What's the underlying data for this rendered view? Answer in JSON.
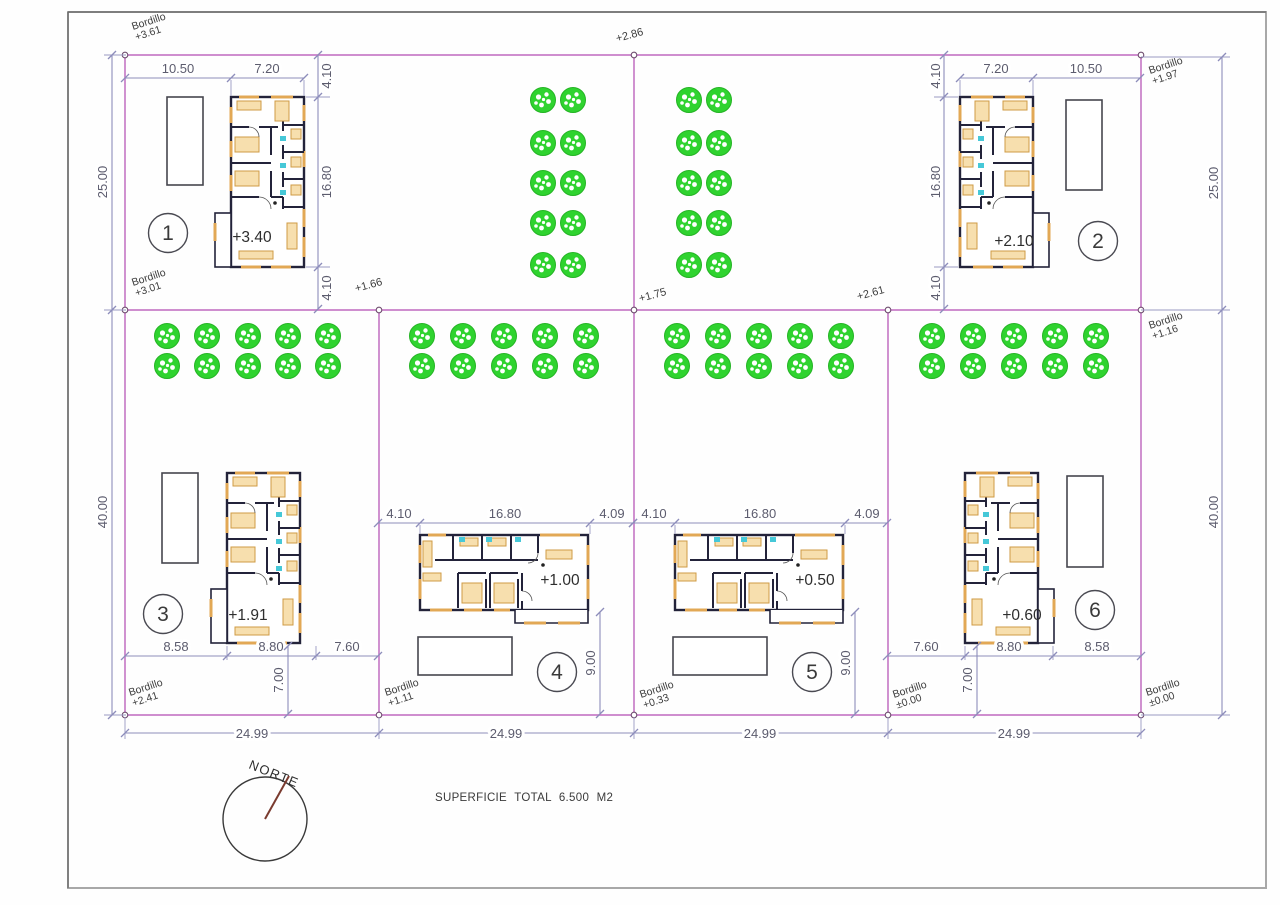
{
  "drawing": {
    "superficie": "SUPERFICIE TOTAL 6.500 M2",
    "north": "NORTE"
  },
  "site": {
    "left_dim_top": "25.00",
    "left_dim_bottom": "40.00",
    "right_dim_top": "25.00",
    "right_dim_bottom": "40.00",
    "bottom_dims": [
      "24.99",
      "24.99",
      "24.99",
      "24.99"
    ],
    "spot": {
      "top": "+2.86",
      "mid_left": "+1.66",
      "mid_center": "+1.75",
      "mid_right": "+2.61"
    },
    "bordillo": [
      {
        "label": "Bordillo",
        "value": "+3.61"
      },
      {
        "label": "Bordillo",
        "value": "+1.97"
      },
      {
        "label": "Bordillo",
        "value": "+3.01"
      },
      {
        "label": "Bordillo",
        "value": "+1.16"
      },
      {
        "label": "Bordillo",
        "value": "+2.41"
      },
      {
        "label": "Bordillo",
        "value": "+1.11"
      },
      {
        "label": "Bordillo",
        "value": "+0.33"
      },
      {
        "label": "Bordillo",
        "value": "±0.00"
      },
      {
        "label": "Bordillo",
        "value": "±0.00"
      }
    ]
  },
  "plots": [
    {
      "number": "1",
      "level": "+3.40",
      "top1": "10.50",
      "top2": "7.20",
      "side1": "4.10",
      "side2": "16.80",
      "side3": "4.10"
    },
    {
      "number": "2",
      "level": "+2.10",
      "top1": "7.20",
      "top2": "10.50",
      "side1": "4.10",
      "side2": "16.80",
      "side3": "4.10"
    },
    {
      "number": "3",
      "level": "+1.91",
      "bot1": "8.58",
      "bot2": "8.80",
      "bot3": "7.60",
      "porch": "7.00"
    },
    {
      "number": "4",
      "level": "+1.00",
      "top1": "4.10",
      "top2": "16.80",
      "top3": "4.09",
      "side": "9.00"
    },
    {
      "number": "5",
      "level": "+0.50",
      "top1": "4.10",
      "top2": "16.80",
      "top3": "4.09",
      "side": "9.00"
    },
    {
      "number": "6",
      "level": "+0.60",
      "bot1": "7.60",
      "bot2": "8.80",
      "bot3": "8.58",
      "porch": "7.00"
    }
  ],
  "colors": {
    "boundary": "#c87ec8",
    "dimension": "#8d8dbb",
    "tree": "#2fd32f",
    "wall": "#23233a",
    "furniture": "#e2a855",
    "window": "#46c8d8",
    "north_needle": "#7a3b2f"
  }
}
